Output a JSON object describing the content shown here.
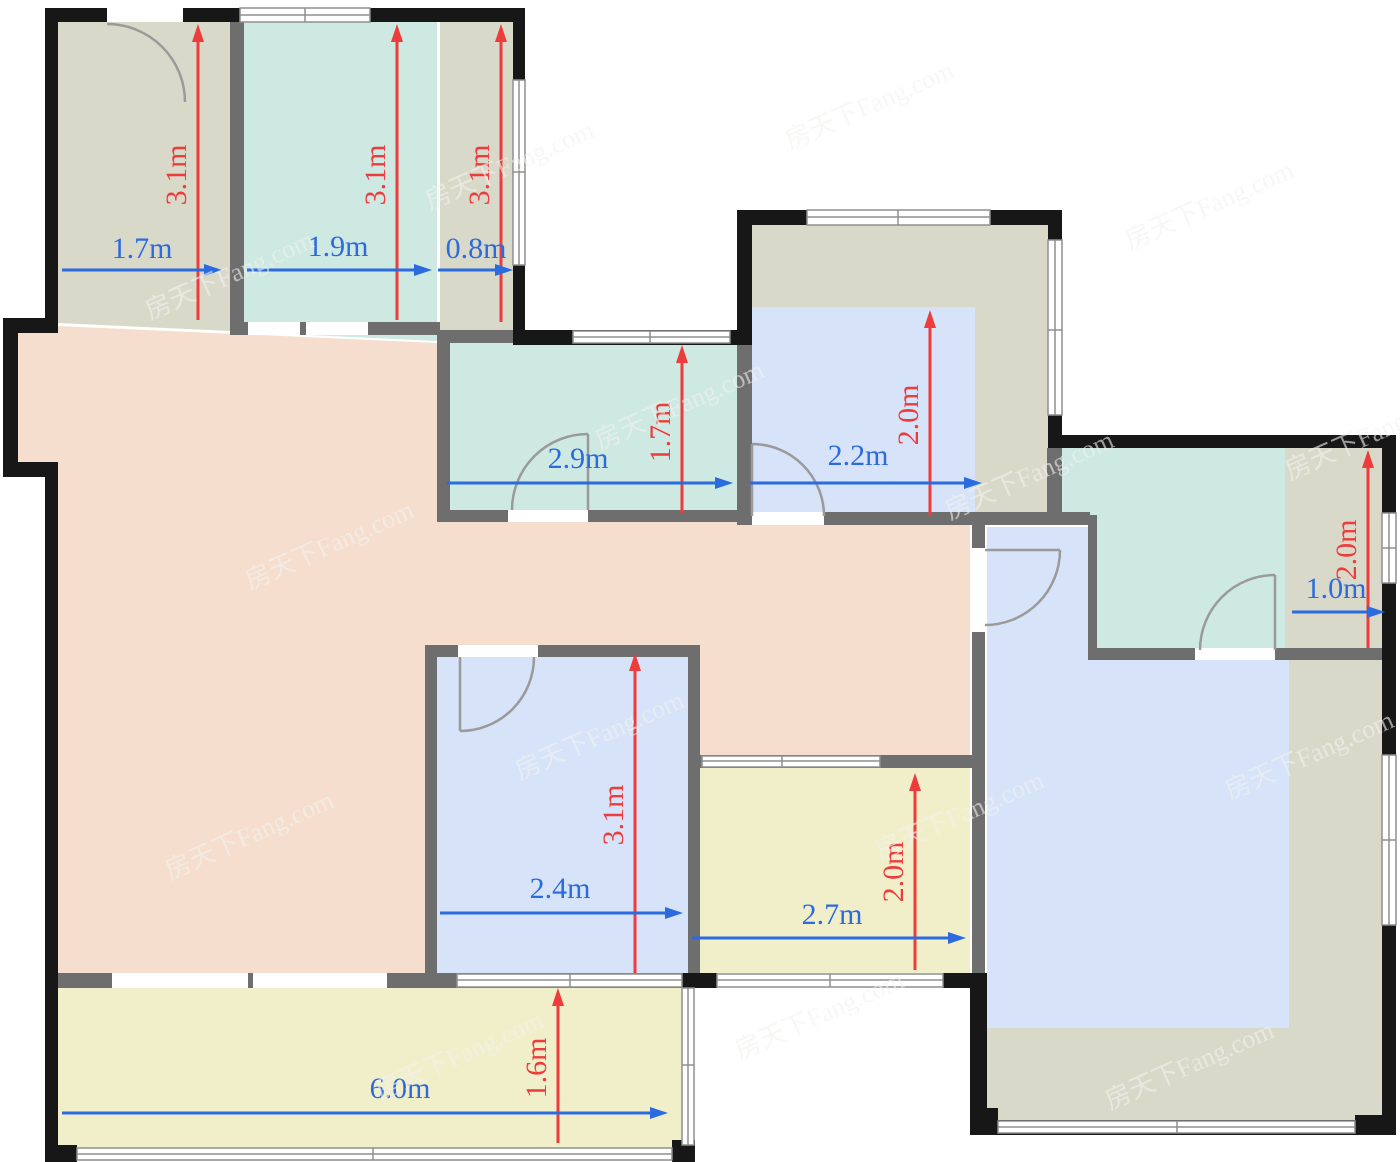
{
  "watermark": {
    "text": "房天下Fang.com"
  },
  "colors": {
    "wall_exterior": "#171717",
    "wall_interior": "#6e6e6e",
    "floor_hall": "#f5decd",
    "floor_gray": "#d9d9ca",
    "floor_teal": "#cde9e1",
    "floor_blue": "#d6e3f8",
    "floor_yellow": "#f1efca",
    "arrow_red": "#ee3b3b",
    "arrow_blue": "#2b6bdf",
    "door_stroke": "#9a9a9a",
    "window_stroke": "#8f8f8f"
  },
  "rooms": [
    {
      "id": "top-left-room",
      "width": "1.7m",
      "height": "3.1m"
    },
    {
      "id": "top-middle-room",
      "width": "1.9m",
      "height": "3.1m"
    },
    {
      "id": "top-right-strip",
      "width": "0.8m",
      "height": "3.1m"
    },
    {
      "id": "middle-teal-room",
      "width": "2.9m",
      "height": "1.7m"
    },
    {
      "id": "upper-right-room",
      "width": "2.2m",
      "height": "2.0m"
    },
    {
      "id": "right-small-room",
      "width": "1.0m",
      "height": "2.0m"
    },
    {
      "id": "center-blue-room",
      "width": "2.4m",
      "height": "3.1m"
    },
    {
      "id": "lower-yellow-room",
      "width": "2.7m",
      "height": "2.0m"
    },
    {
      "id": "balcony",
      "width": "6.0m",
      "height": "1.6m"
    }
  ]
}
